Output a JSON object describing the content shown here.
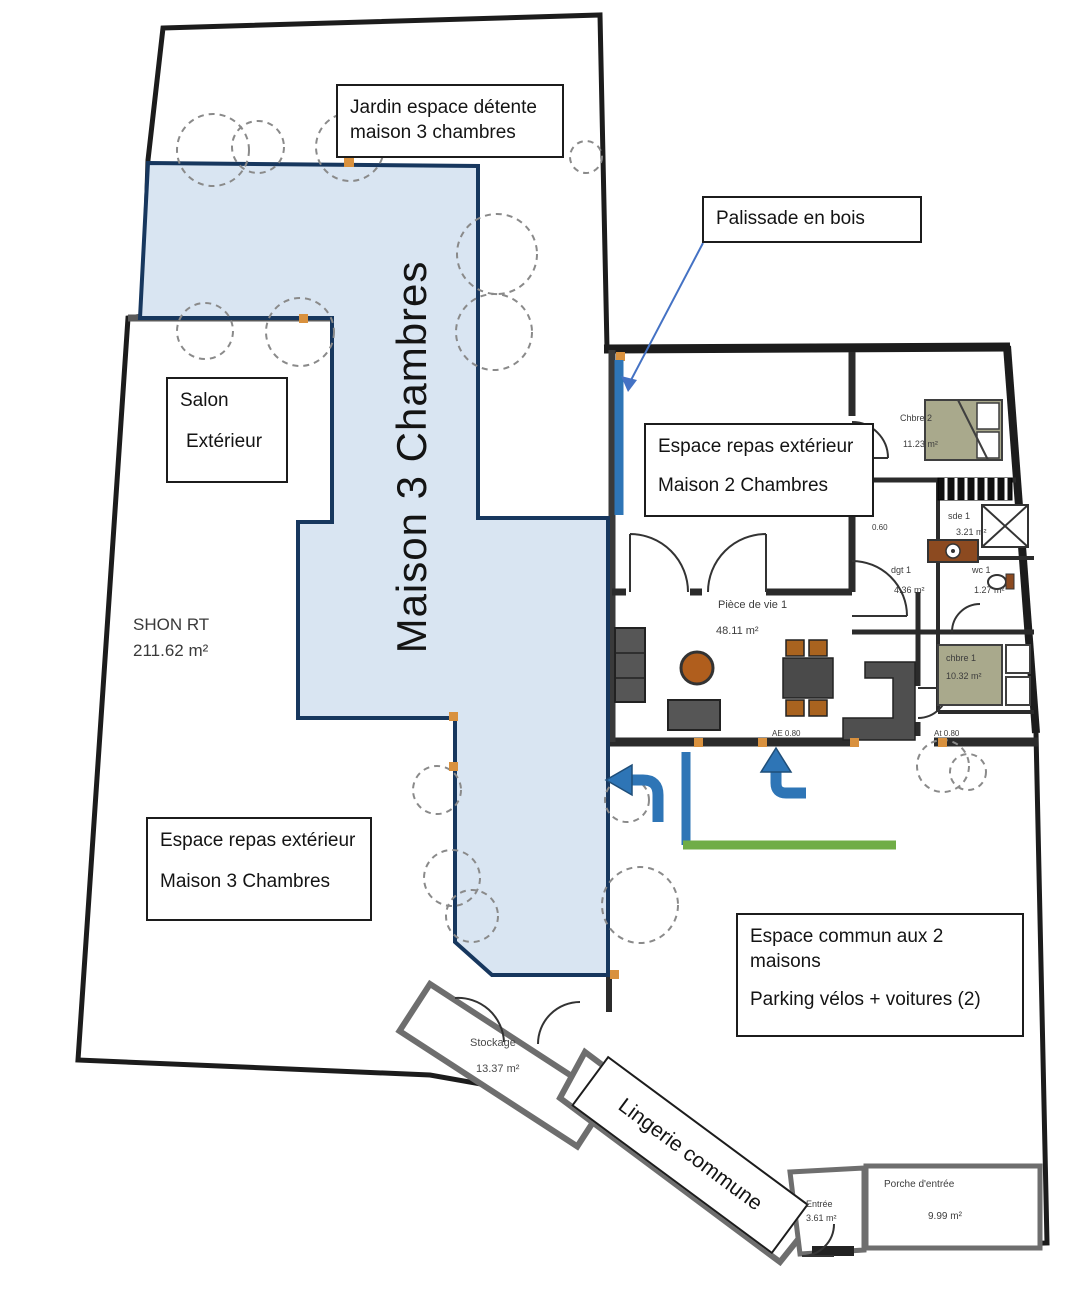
{
  "plan": {
    "annotations": {
      "jardin": {
        "line1": "Jardin espace détente",
        "line2": "maison 3 chambres"
      },
      "palissade": {
        "text": "Palissade en bois"
      },
      "salon": {
        "line1": "Salon",
        "line2": "Extérieur"
      },
      "repas_m2": {
        "line1": "Espace repas extérieur",
        "line2": "Maison 2 Chambres"
      },
      "repas_m3": {
        "line1": "Espace repas extérieur",
        "line2": "Maison 3 Chambres"
      },
      "commun": {
        "line1": "Espace commun aux 2",
        "line2": "maisons",
        "line3": "Parking vélos + voitures (2)"
      },
      "shon": {
        "line1": "SHON RT",
        "line2": "211.62 m²"
      },
      "maison3_banner": "Maison 3 Chambres",
      "lingerie_banner": "Lingerie commune"
    },
    "rooms": {
      "chbre2": {
        "name": "Chbre 2",
        "area": "11.23 m²"
      },
      "sde1": {
        "name": "sde 1",
        "area": "3.21 m²"
      },
      "dgt1": {
        "name": "dgt 1",
        "area": "4.36 m²"
      },
      "wc1": {
        "name": "wc 1",
        "area": "1.27 m²"
      },
      "chbre1": {
        "name": "chbre 1",
        "area": "10.32 m²"
      },
      "piece_de_vie1": {
        "name": "Pièce de vie 1",
        "area": "48.11 m²"
      },
      "stockage": {
        "name": "Stockage",
        "area": "13.37 m²"
      },
      "entree": {
        "name": "Entrée",
        "area": "3.61 m²"
      },
      "porche": {
        "name": "Porche d'entrée",
        "area": "9.99 m²"
      }
    },
    "wall_marks": {
      "m1": "AE 0.80",
      "m2": "At 0.80",
      "m3": "0.60"
    },
    "colors": {
      "maison3_fill": "#d9e5f2",
      "maison3_stroke": "#17375e",
      "marker_blue": "#2e75b6",
      "marker_green": "#70ad47",
      "boundary_dark": "#1c1c1c",
      "wall_gray": "#6e6e6e",
      "wood_accent": "#d9913e",
      "furniture_dark": "#555555",
      "furniture_brown": "#b05e1d",
      "bed_olive": "#a9a98c"
    }
  }
}
